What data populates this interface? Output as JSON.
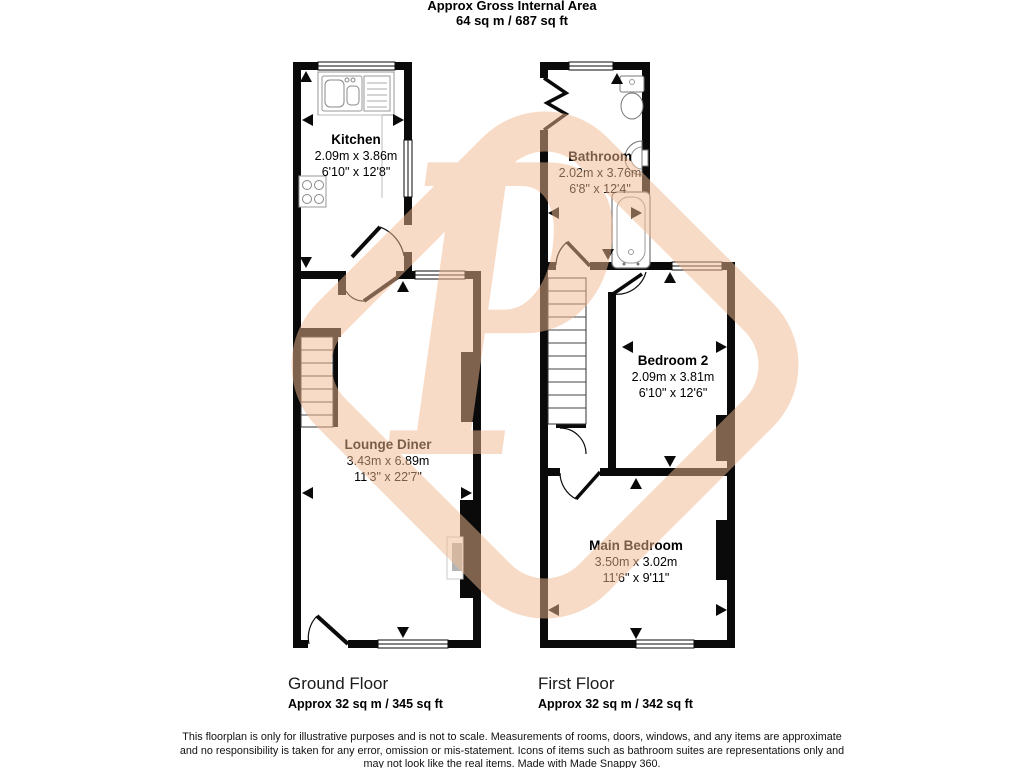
{
  "header": {
    "title": "Approx Gross Internal Area",
    "area": "64 sq m / 687 sq ft"
  },
  "watermark": {
    "letter": "P",
    "color": "#f3b98f"
  },
  "rooms": {
    "kitchen": {
      "name": "Kitchen",
      "metric": "2.09m x 3.86m",
      "imperial": "6'10\" x 12'8\""
    },
    "lounge": {
      "name": "Lounge Diner",
      "metric": "3.43m x 6.89m",
      "imperial": "11'3\" x 22'7\""
    },
    "bathroom": {
      "name": "Bathroom",
      "metric": "2.02m x 3.76m",
      "imperial": "6'8\" x 12'4\""
    },
    "bedroom2": {
      "name": "Bedroom 2",
      "metric": "2.09m x 3.81m",
      "imperial": "6'10\" x 12'6\""
    },
    "main_bedroom": {
      "name": "Main Bedroom",
      "metric": "3.50m x 3.02m",
      "imperial": "11'6\" x 9'11\""
    }
  },
  "floors": {
    "ground": {
      "label": "Ground Floor",
      "area": "Approx 32 sq m / 345 sq ft"
    },
    "first": {
      "label": "First Floor",
      "area": "Approx 32 sq m / 342 sq ft"
    }
  },
  "disclaimer": {
    "line1": "This floorplan is only for illustrative purposes and is not to scale. Measurements of rooms, doors, windows, and any items are approximate",
    "line2": "and no responsibility is taken for any error, omission or mis-statement. Icons of items such as bathroom suites are representations only and",
    "line3": "may not look like the real items. Made with Made Snappy 360."
  }
}
